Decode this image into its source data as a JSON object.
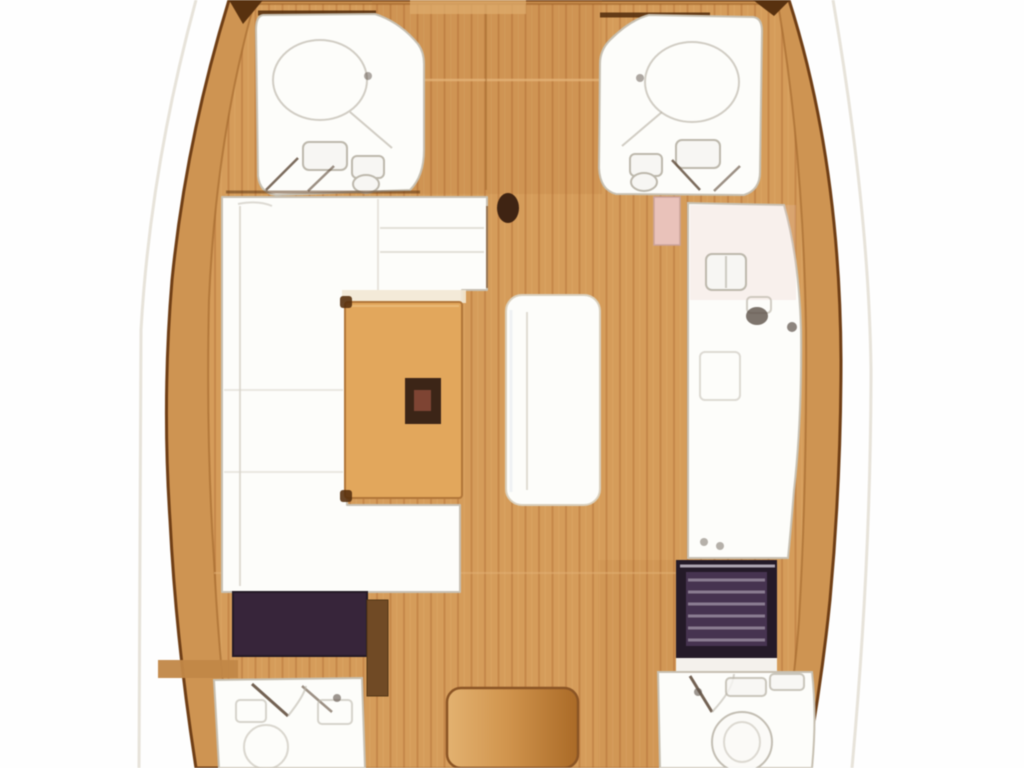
{
  "meta": {
    "kind": "sailboat-interior-floor-plan",
    "view": "overhead"
  },
  "colors": {
    "exterior": "#fefefe",
    "toerail_faint": "#e7e3da",
    "hull_line": "#6e3e16",
    "deck_wood": "#cd9453",
    "deck_wood_light": "#dcab6c",
    "floor_plank_light": "#d49c5b",
    "floor_plank_dark": "#c4874a",
    "floor_inner_line": "#9a6128",
    "fwd_tint": "#b06a30",
    "seam_light": "#e3b377",
    "trim_dark": "#573110",
    "furniture_white": "#fdfdfa",
    "furniture_outline": "#c7c0b2",
    "fixture_fill": "#f7f6f3",
    "fixture_line": "#bdb8ac",
    "fixture_dark": "#5d5148",
    "door_line": "#5c4836",
    "table_wood": "#e1a75e",
    "table_border": "#b0763a",
    "table_highlight": "#eec687",
    "table_inset_dark": "#3c2517",
    "table_inset_red": "#7d4434",
    "sofa_lip": "#f2e8d4",
    "cushion_line": "#d9d5ca",
    "sideboard_line": "#7a4a22",
    "bench_border": "#d9cfbc",
    "bench_shade": "#e3e8ef",
    "mast_dark": "#3f2413",
    "pink_door": "#e8c2ba",
    "pink_door_border": "#c9a29a",
    "chart_table_dark": "#37253a",
    "chart_border": "#241a26",
    "seat_brown": "#6f4a26",
    "seat_border": "#523516",
    "stove_frame": "#241a28",
    "stove_body": "#463350",
    "stove_stripe": "#9b8fa0",
    "stove_highlight": "#cfc6d2",
    "white_strip": "#f4f1ec",
    "companionway_light": "#e2b271",
    "companionway_mid": "#d09550",
    "companionway_dark": "#a96a28",
    "companionway_border": "#8a5526",
    "deck_band": "#c08748",
    "toilet_fill": "#fbfaf7"
  }
}
